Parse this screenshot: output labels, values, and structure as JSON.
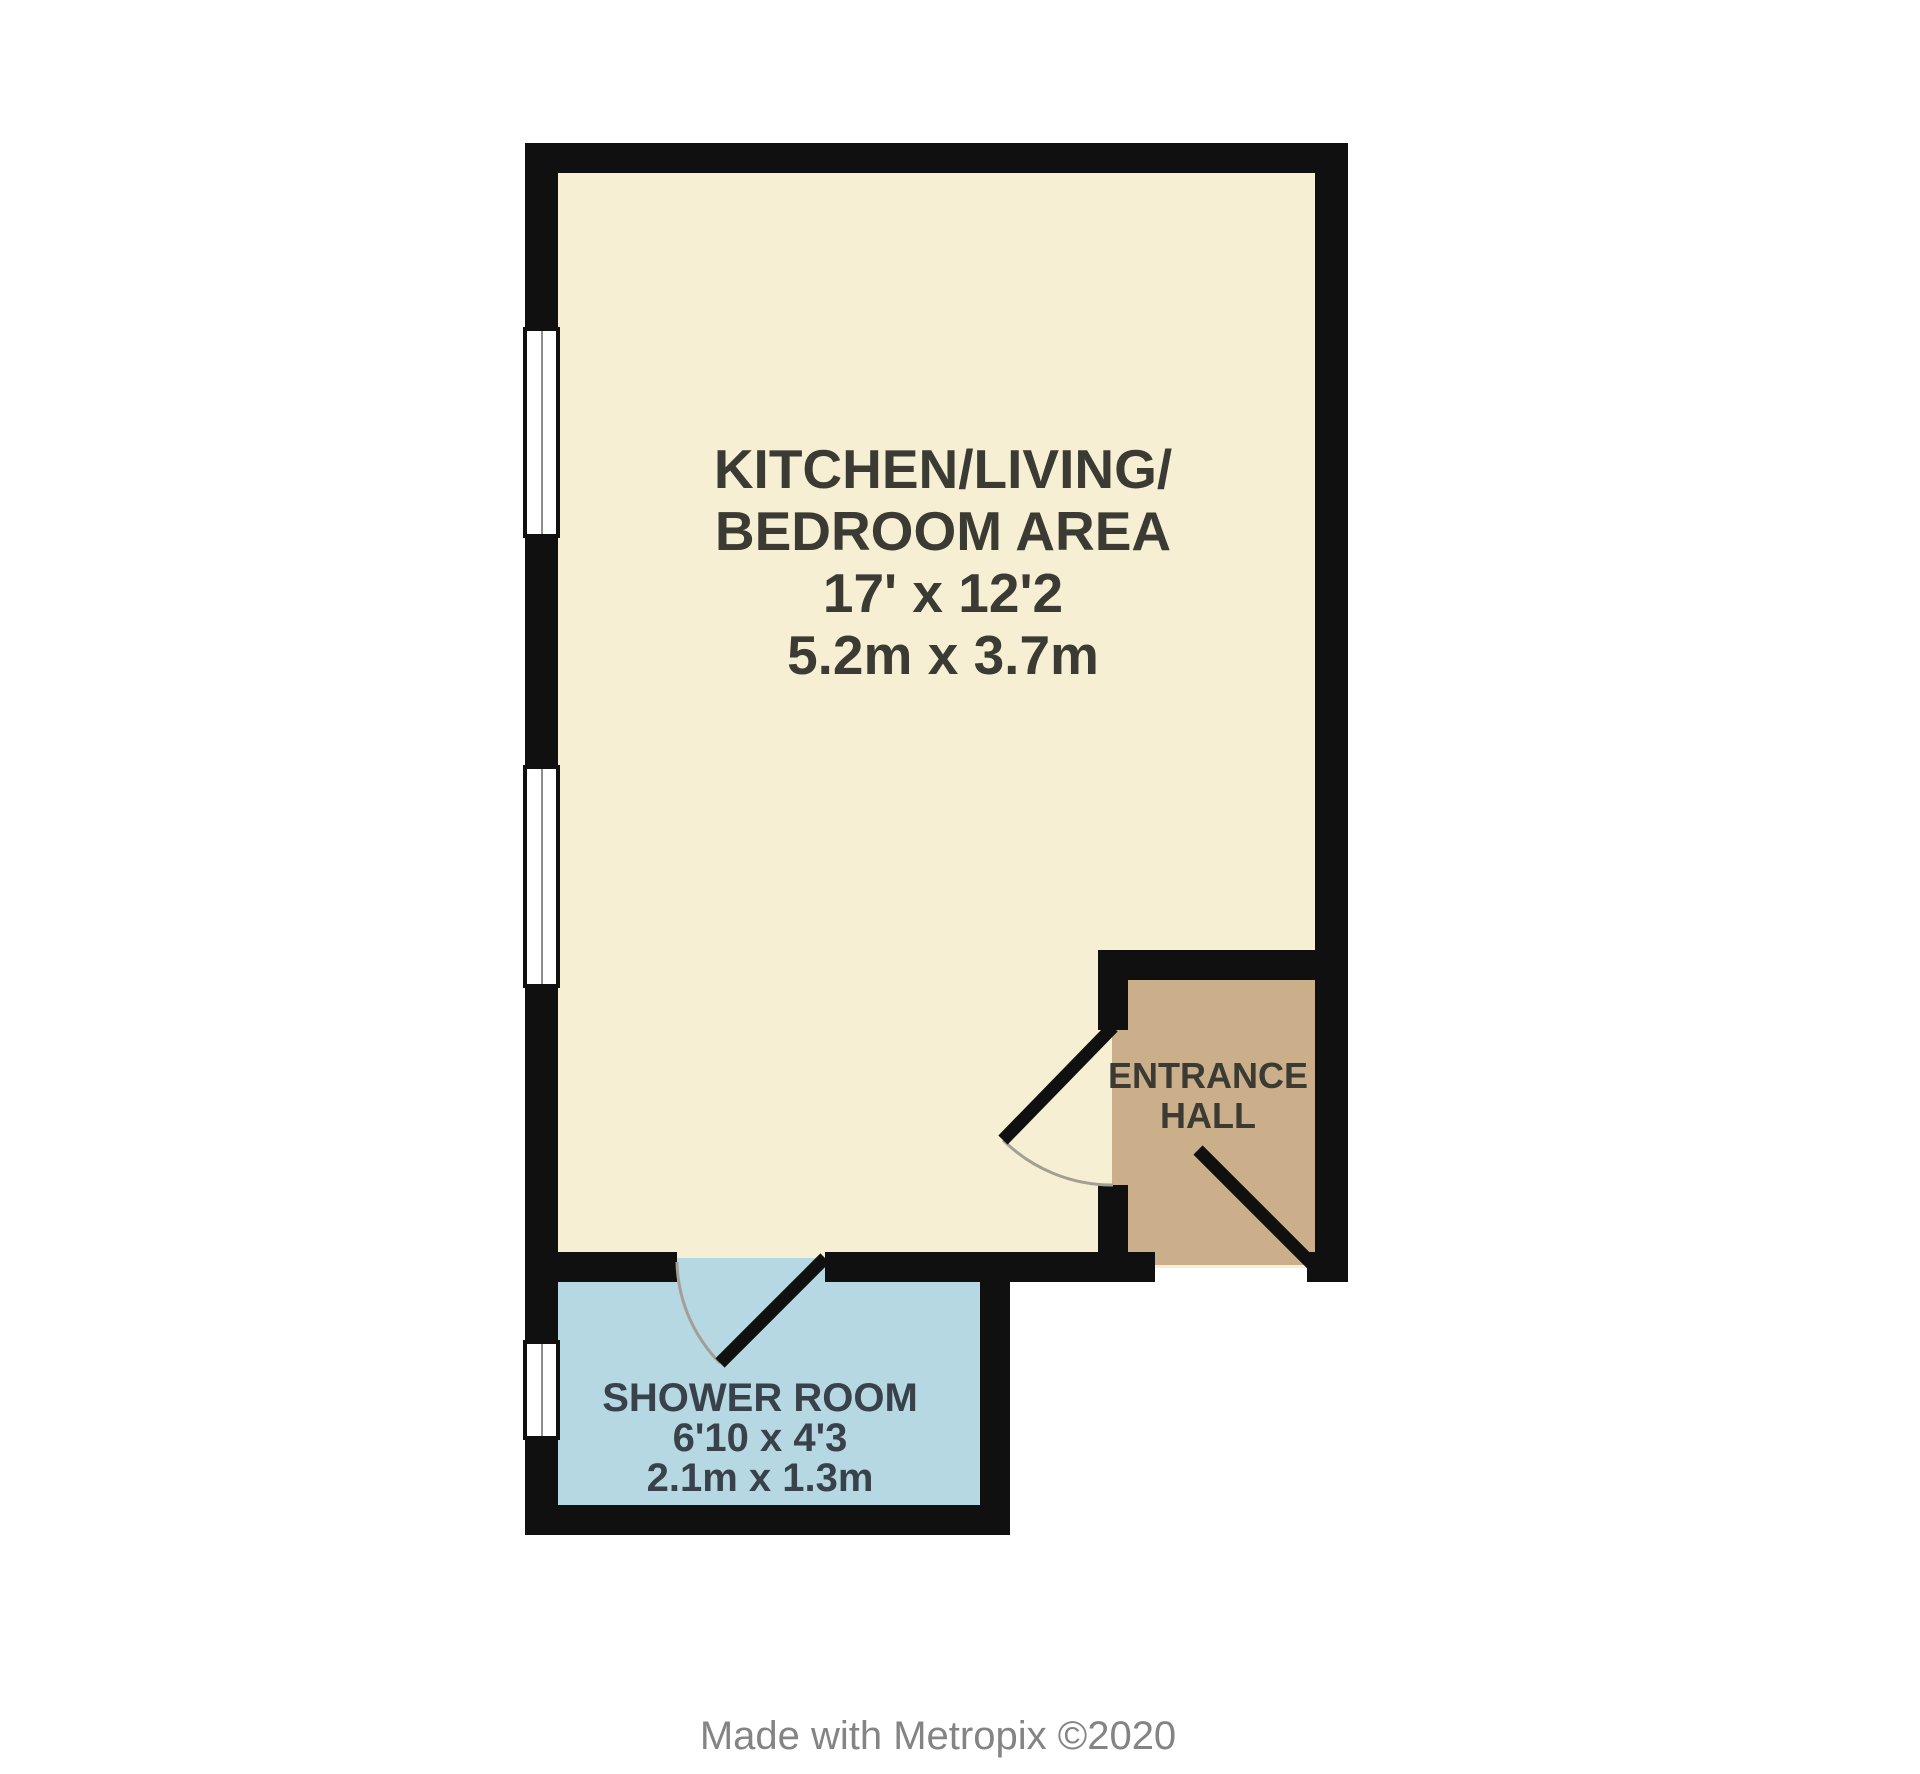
{
  "palette": {
    "wall": "#101010",
    "door_arc": "#a39f96",
    "window_glass": "#ffffff",
    "background": "#ffffff"
  },
  "rooms": {
    "main": {
      "fill": "#f6efd3",
      "text_color": "#3b3a33",
      "lines": [
        "KITCHEN/LIVING/",
        "BEDROOM AREA",
        "17' x 12'2",
        "5.2m x 3.7m"
      ]
    },
    "hall": {
      "fill": "#cbae8a",
      "text_color": "#3b3a33",
      "lines": [
        "ENTRANCE",
        "HALL"
      ]
    },
    "shower": {
      "fill": "#b5d8e2",
      "text_color": "#39424a",
      "lines": [
        "SHOWER ROOM",
        "6'10 x 4'3",
        "2.1m x 1.3m"
      ]
    }
  },
  "credit": {
    "text": "Made with Metropix ©2020",
    "color": "#848484"
  }
}
